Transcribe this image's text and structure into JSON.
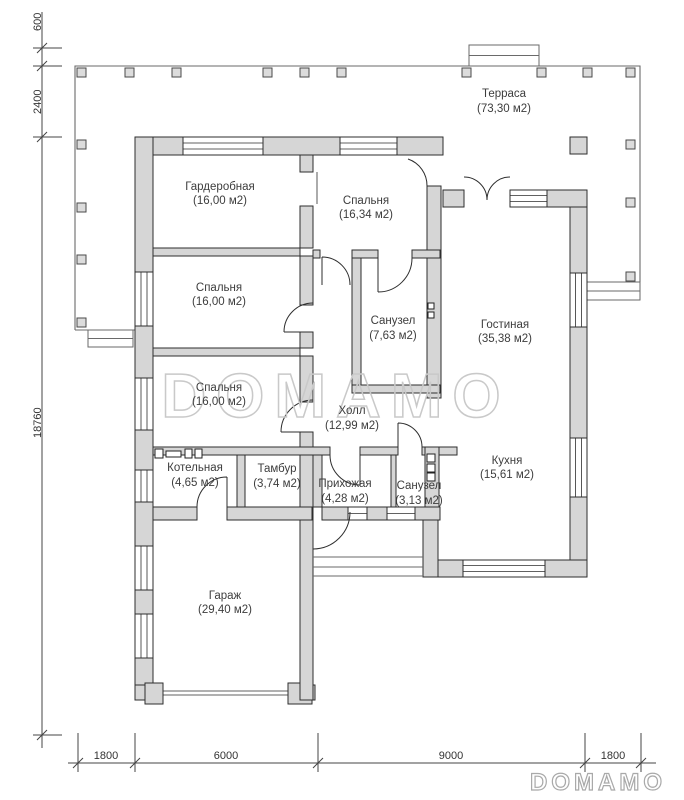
{
  "watermarks": {
    "center": "DOMAMO",
    "corner": "DOMAMO"
  },
  "rooms": [
    {
      "name": "Терраса",
      "area": "(73,30 м2)"
    },
    {
      "name": "Гардеробная",
      "area": "(16,00 м2)"
    },
    {
      "name": "Спальня",
      "area": "(16,34 м2)"
    },
    {
      "name": "Спальня",
      "area": "(16,00 м2)"
    },
    {
      "name": "Санузел",
      "area": "(7,63 м2)"
    },
    {
      "name": "Гостиная",
      "area": "(35,38 м2)"
    },
    {
      "name": "Спальня",
      "area": "(16,00 м2)"
    },
    {
      "name": "Холл",
      "area": "(12,99 м2)"
    },
    {
      "name": "Котельная",
      "area": "(4,65 м2)"
    },
    {
      "name": "Тамбур",
      "area": "(3,74 м2)"
    },
    {
      "name": "Прихожая",
      "area": "(4,28 м2)"
    },
    {
      "name": "Санузел",
      "area": "(3,13 м2)"
    },
    {
      "name": "Кухня",
      "area": "(15,61 м2)"
    },
    {
      "name": "Гараж",
      "area": "(29,40 м2)"
    }
  ],
  "dimensions": {
    "left": [
      "600",
      "2400",
      "18760"
    ],
    "bottom": [
      "1800",
      "6000",
      "9000",
      "1800"
    ]
  },
  "colors": {
    "wall_fill": "#d6d6d6",
    "wall_stroke": "#2e2e2e",
    "terrace_stroke": "#6a6a6a",
    "label_text": "#3d3d3d",
    "watermark": "#c9c9c9"
  }
}
